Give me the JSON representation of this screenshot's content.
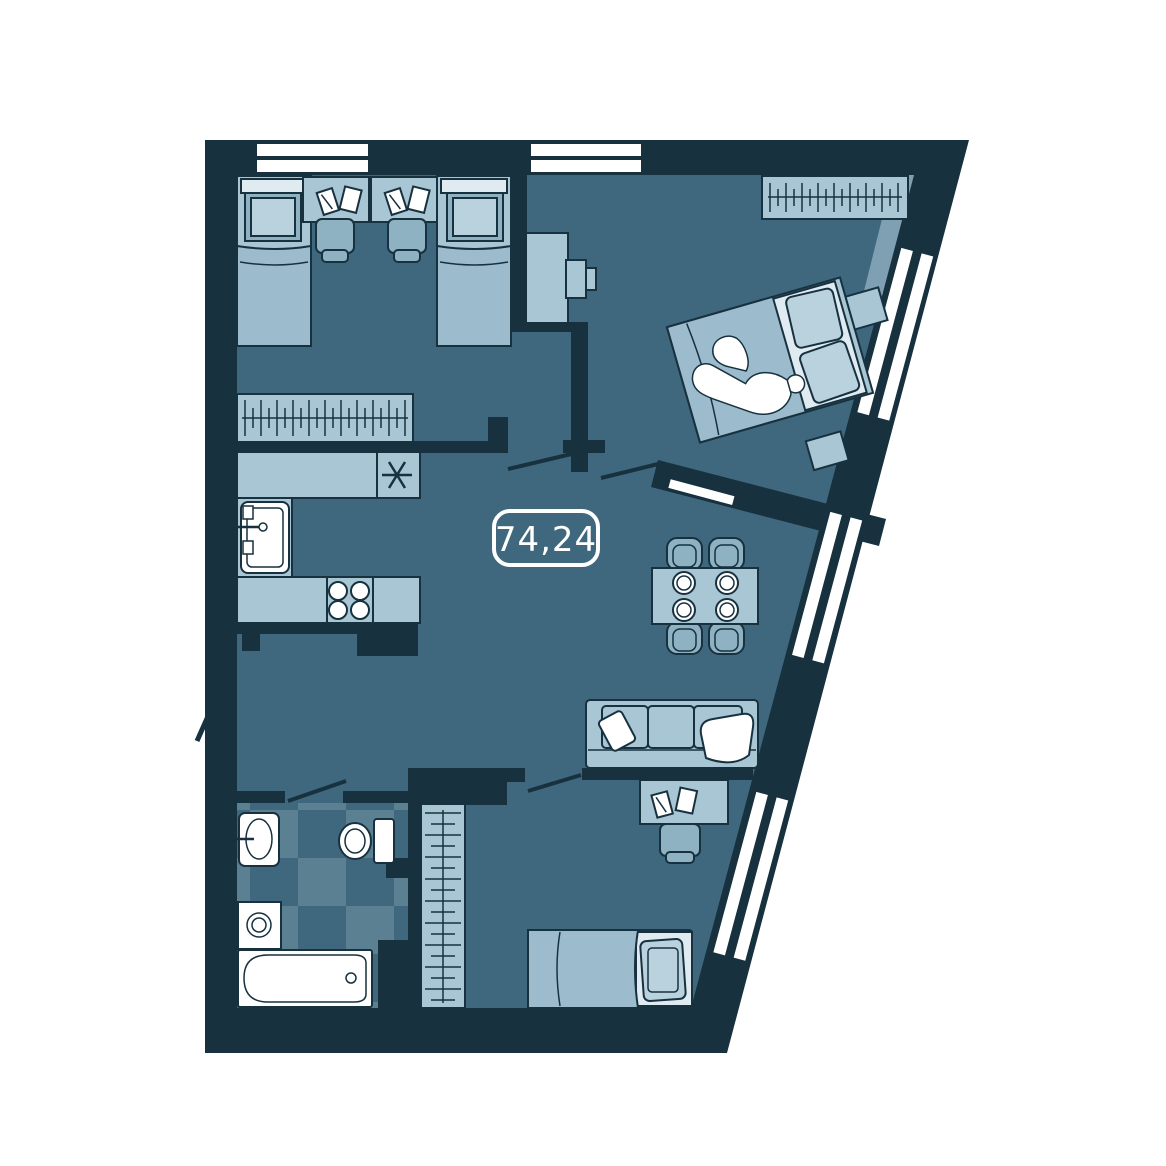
{
  "plan": {
    "area_label": "74,24",
    "type": "apartment-floor-plan",
    "colors": {
      "wall": "#17313f",
      "floor": "#3f687e",
      "floor_tile_light": "#5b8091",
      "furniture_light": "#a9c6d5",
      "furniture_medium": "#8fb2c3",
      "blanket": "#9cbccd",
      "pillow": "#b9d2de",
      "sheet": "#dfeaf1",
      "white": "#ffffff",
      "accent_zone": "#7ea0b2"
    },
    "rooms": [
      {
        "id": "kids-room",
        "furniture": [
          "single-bed",
          "single-bed",
          "desk",
          "desk",
          "chair",
          "chair",
          "books",
          "wardrobe-with-hangers"
        ]
      },
      {
        "id": "master-bedroom",
        "furniture": [
          "double-bed",
          "sleeping-person",
          "wardrobe-with-hangers",
          "tv-dresser",
          "nightstand",
          "bench"
        ]
      },
      {
        "id": "kitchen",
        "furniture": [
          "counter-top",
          "sink",
          "hob-4-burners",
          "asterisk-symbol"
        ]
      },
      {
        "id": "living-dining",
        "furniture": [
          "dining-table",
          "chair",
          "chair",
          "chair",
          "chair",
          "plates-4",
          "sofa-3-seat",
          "pillow",
          "blanket"
        ]
      },
      {
        "id": "bathroom",
        "furniture": [
          "washbasin",
          "toilet",
          "washing-machine",
          "bathtub",
          "checkered-tile-floor"
        ]
      },
      {
        "id": "bedroom",
        "furniture": [
          "single-bed",
          "desk",
          "chair",
          "books",
          "wardrobe-rail"
        ]
      },
      {
        "id": "hall",
        "furniture": []
      }
    ],
    "windows": {
      "top_wall_windows": 2,
      "slanted_wall_window_groups": 3
    },
    "doors": [
      "entrance",
      "kids-room-door",
      "master-bedroom-door",
      "bathroom-door",
      "bedroom-door"
    ]
  }
}
